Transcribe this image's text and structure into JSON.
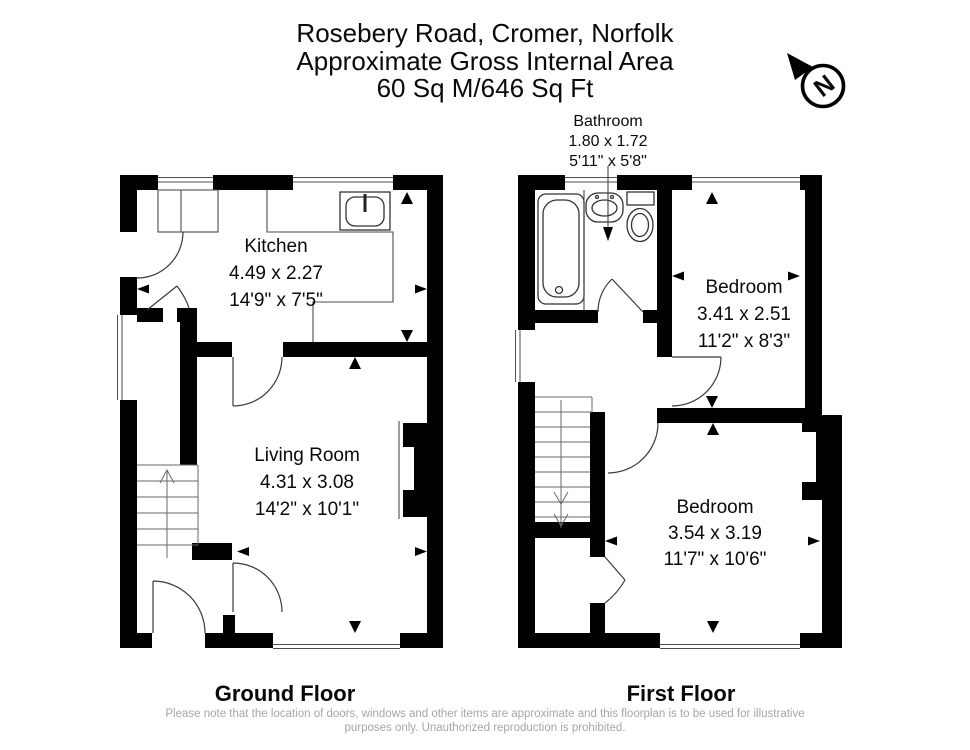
{
  "title": {
    "line1": "Rosebery Road, Cromer, Norfolk",
    "line2": "Approximate Gross Internal Area",
    "line3": "60 Sq M/646 Sq Ft"
  },
  "compass": {
    "label": "N"
  },
  "ground_floor": {
    "label": "Ground Floor",
    "kitchen": {
      "name": "Kitchen",
      "metric": "4.49 x 2.27",
      "imperial": "14'9\" x 7'5\""
    },
    "living_room": {
      "name": "Living Room",
      "metric": "4.31 x 3.08",
      "imperial": "14'2\" x 10'1\""
    }
  },
  "first_floor": {
    "label": "First Floor",
    "bathroom": {
      "name": "Bathroom",
      "metric": "1.80 x 1.72",
      "imperial": "5'11\" x 5'8\""
    },
    "bedroom1": {
      "name": "Bedroom",
      "metric": "3.41 x 2.51",
      "imperial": "11'2\" x 8'3\""
    },
    "bedroom2": {
      "name": "Bedroom",
      "metric": "3.54 x 3.19",
      "imperial": "11'7\" x 10'6\""
    }
  },
  "footer": {
    "line1": "Please note that the location of doors, windows and other items are approximate and this floorplan is to be used for illustrative",
    "line2": "purposes only. Unauthorized reproduction is prohibited."
  },
  "colors": {
    "wall": "#000000",
    "disclaimer": "#a6a6a6"
  }
}
